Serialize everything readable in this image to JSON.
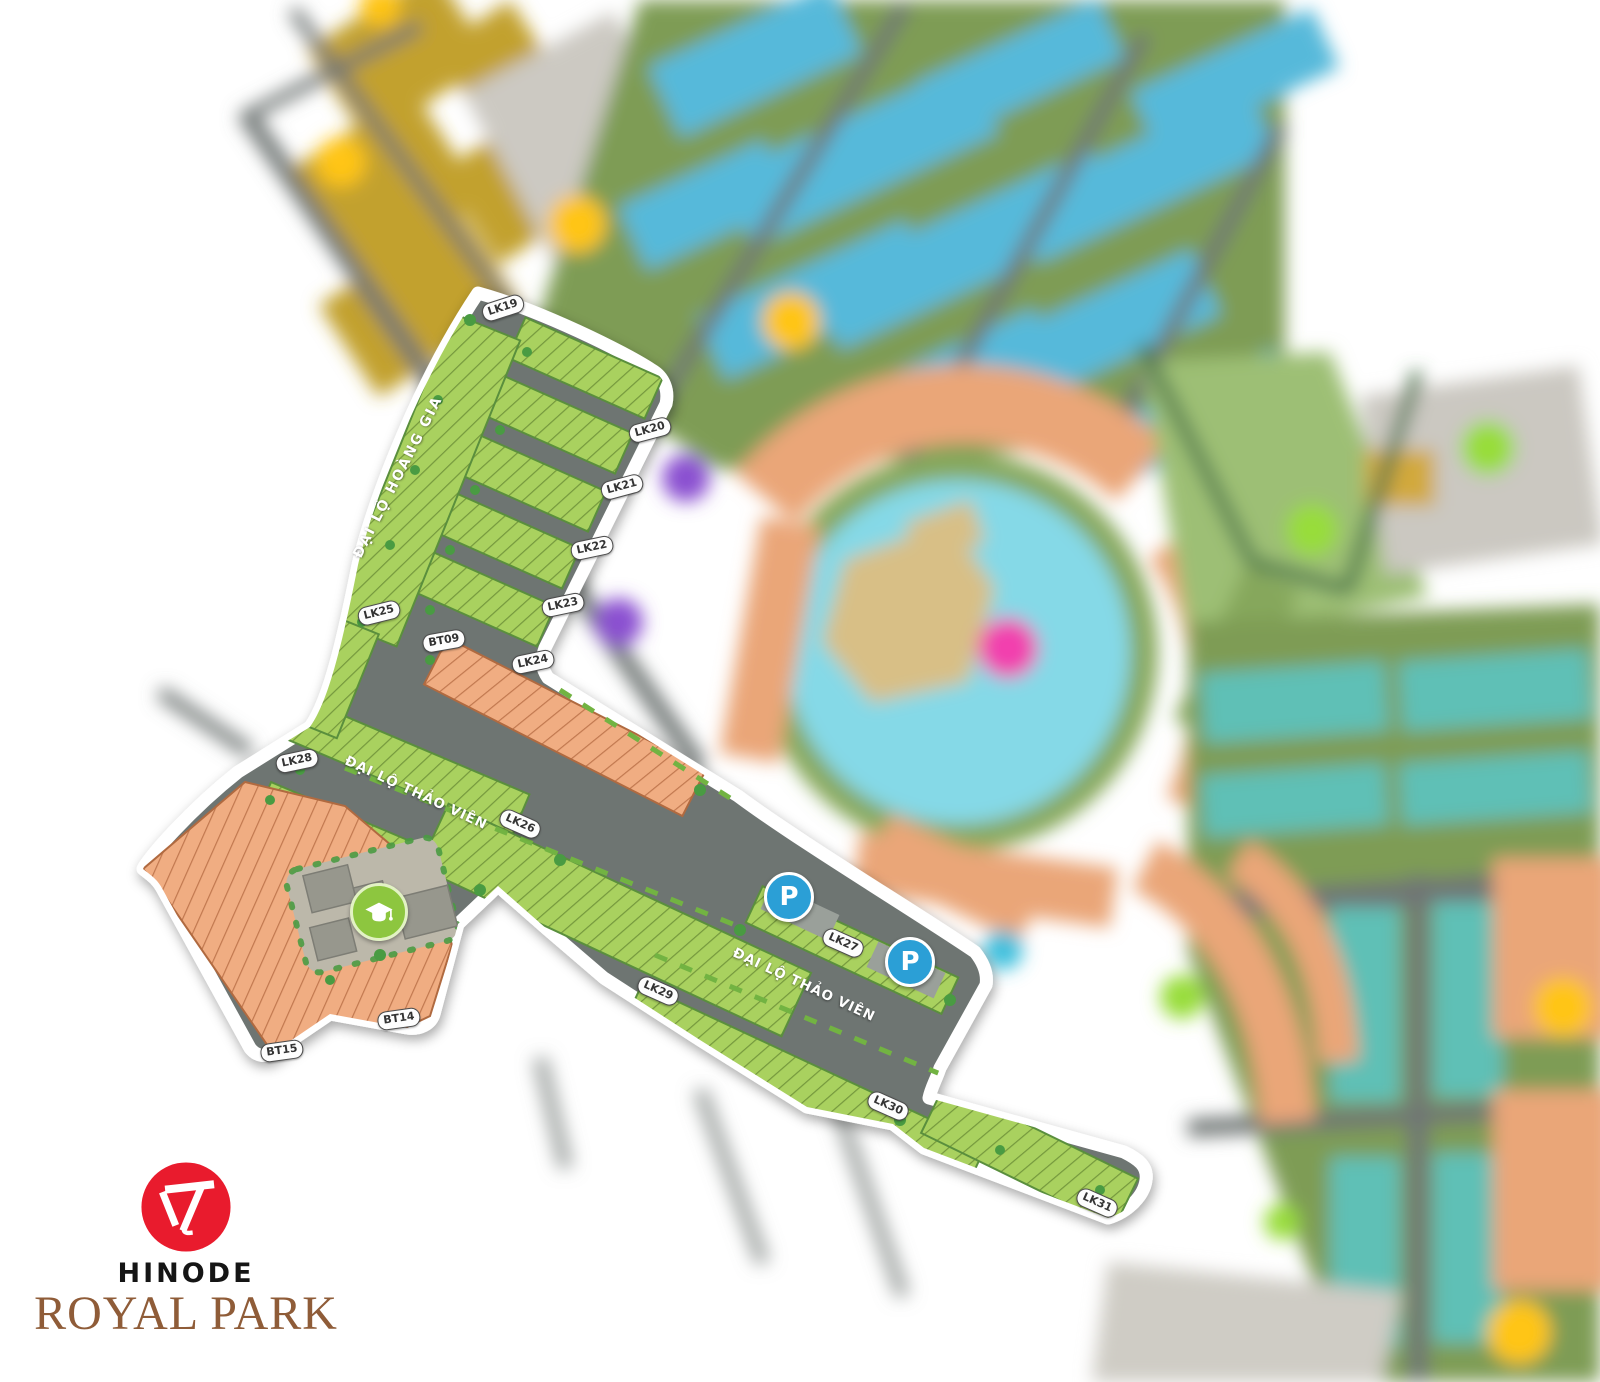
{
  "page": {
    "width": 1600,
    "height": 1382,
    "background": "#ffffff"
  },
  "logo": {
    "brand_line1": "HINODE",
    "brand_line2": "ROYAL PARK",
    "circle_color": "#e91b2d",
    "line1_color": "#151515",
    "line2_color": "#8f5c38"
  },
  "map": {
    "streets": [
      {
        "id": "dai-lo-hoang-gia",
        "label": "ĐẠI LỘ HOÀNG GIA",
        "x": 398,
        "y": 477,
        "rotation": -63,
        "vertical": true
      },
      {
        "id": "dai-lo-thao-vien-upper",
        "label": "ĐẠI LỘ THẢO VIÊN",
        "x": 416,
        "y": 793,
        "rotation": 25,
        "vertical": false
      },
      {
        "id": "dai-lo-thao-vien-lower",
        "label": "ĐẠI LỘ THẢO VIÊN",
        "x": 804,
        "y": 985,
        "rotation": 25,
        "vertical": false
      }
    ],
    "plot_labels": [
      {
        "name": "LK19",
        "x": 503,
        "y": 308,
        "rotation": -18
      },
      {
        "name": "LK20",
        "x": 650,
        "y": 430,
        "rotation": -15
      },
      {
        "name": "LK21",
        "x": 622,
        "y": 487,
        "rotation": -15
      },
      {
        "name": "LK22",
        "x": 592,
        "y": 548,
        "rotation": -12
      },
      {
        "name": "LK23",
        "x": 563,
        "y": 605,
        "rotation": -12
      },
      {
        "name": "LK24",
        "x": 533,
        "y": 662,
        "rotation": -12
      },
      {
        "name": "LK25",
        "x": 379,
        "y": 613,
        "rotation": -14
      },
      {
        "name": "BT09",
        "x": 444,
        "y": 641,
        "rotation": -10
      },
      {
        "name": "LK28",
        "x": 297,
        "y": 761,
        "rotation": -12
      },
      {
        "name": "LK26",
        "x": 520,
        "y": 824,
        "rotation": 24
      },
      {
        "name": "LK27",
        "x": 843,
        "y": 943,
        "rotation": 24
      },
      {
        "name": "LK29",
        "x": 658,
        "y": 991,
        "rotation": 24
      },
      {
        "name": "LK30",
        "x": 888,
        "y": 1106,
        "rotation": 24
      },
      {
        "name": "LK31",
        "x": 1097,
        "y": 1203,
        "rotation": 24
      },
      {
        "name": "BT14",
        "x": 399,
        "y": 1019,
        "rotation": -8
      },
      {
        "name": "BT15",
        "x": 282,
        "y": 1051,
        "rotation": -8
      }
    ],
    "markers": {
      "parking": [
        {
          "label": "P",
          "x": 789,
          "y": 897
        },
        {
          "label": "P",
          "x": 910,
          "y": 962
        }
      ],
      "school": {
        "icon": "graduation-cap-icon",
        "x": 379,
        "y": 912
      }
    },
    "legend_colors": {
      "residential_green": "#a9d15e",
      "villa_orange": "#f0ad82",
      "road_gray": "#6e7472",
      "boundary_white": "#ffffff",
      "parking_blue": "#2b9fd6",
      "school_green": "#8dc63f",
      "lake_cyan": "#85d9e7",
      "blurred_blue_plots": "#57b9da",
      "blurred_teal_plots": "#5fc0b6",
      "blurred_mustard_plots": "#c2a12f"
    }
  }
}
